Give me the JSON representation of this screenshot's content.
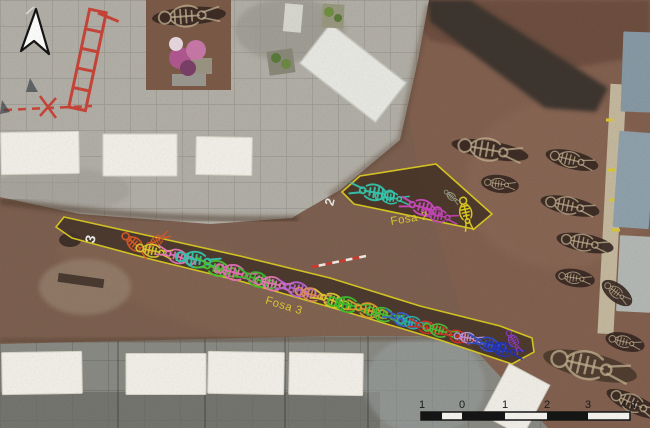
{
  "figure": {
    "description": "Aerial orthophoto of archaeological excavation with two mass graves and individual burials",
    "icons": {
      "north_arrow": "north-arrow-icon",
      "ranging_rod": "ranging-rod",
      "scale_bar": "scale-bar"
    },
    "labels": {
      "fosa2": {
        "name": "Fosa 2",
        "number": "2",
        "label_color": "#dcc832",
        "number_color": "#ececе8"
      },
      "fosa3": {
        "name": "Fosa 3",
        "number": "3",
        "label_color": "#dcc832",
        "number_color": "#ececе8"
      }
    },
    "outline_color": "#d6c623"
  },
  "scalebar": {
    "unit": "m",
    "tick_labels": [
      "1",
      "0",
      "1",
      "2",
      "3",
      "4 m"
    ],
    "ticks": [
      {
        "label": "1",
        "x": 422
      },
      {
        "label": "0",
        "x": 462
      },
      {
        "label": "1",
        "x": 505
      },
      {
        "label": "2",
        "x": 547
      },
      {
        "label": "3",
        "x": 588
      },
      {
        "label": "4 m",
        "x": 630
      }
    ],
    "segments": [
      {
        "x": 421,
        "w": 21,
        "fill": "#151515"
      },
      {
        "x": 442,
        "w": 20,
        "fill": "#f6f4ee"
      },
      {
        "x": 462,
        "w": 43,
        "fill": "#151515"
      },
      {
        "x": 505,
        "w": 42,
        "fill": "#f6f4ee"
      },
      {
        "x": 547,
        "w": 41,
        "fill": "#151515"
      },
      {
        "x": 588,
        "w": 42,
        "fill": "#f6f4ee"
      }
    ],
    "bar": {
      "y": 412,
      "h": 8
    }
  },
  "skeletons": {
    "fosa2": [
      {
        "x": 372,
        "y": 192,
        "a": 190,
        "sc": 1.05,
        "c": "#35c7ae"
      },
      {
        "x": 392,
        "y": 198,
        "a": 8,
        "sc": 0.8,
        "c": "#35c7ae"
      },
      {
        "x": 421,
        "y": 207,
        "a": 195,
        "sc": 1.0,
        "c": "#cc4ac0"
      },
      {
        "x": 440,
        "y": 216,
        "a": 12,
        "sc": 0.85,
        "c": "#c043b6"
      },
      {
        "x": 466,
        "y": 214,
        "a": 78,
        "sc": 0.8,
        "c": "#e0d020"
      },
      {
        "x": 452,
        "y": 197,
        "a": 40,
        "sc": 0.45,
        "c": "#9aa08a"
      }
    ],
    "fosa3": [
      {
        "x": 158,
        "y": 240,
        "a": -30,
        "sc": 0.6,
        "c": "#e05826"
      },
      {
        "x": 136,
        "y": 245,
        "a": 40,
        "sc": 0.8,
        "c": "#e05826"
      },
      {
        "x": 154,
        "y": 251,
        "a": 12,
        "sc": 0.85,
        "c": "#d9cb2e"
      },
      {
        "x": 176,
        "y": 256,
        "a": 198,
        "sc": 0.9,
        "c": "#e878bc"
      },
      {
        "x": 198,
        "y": 260,
        "a": 10,
        "sc": 1.05,
        "c": "#35c7ae"
      },
      {
        "x": 216,
        "y": 268,
        "a": 195,
        "sc": 1.0,
        "c": "#4cc232"
      },
      {
        "x": 236,
        "y": 273,
        "a": 15,
        "sc": 1.0,
        "c": "#e470b4"
      },
      {
        "x": 256,
        "y": 279,
        "a": 200,
        "sc": 0.95,
        "c": "#3fbe2c"
      },
      {
        "x": 274,
        "y": 284,
        "a": 12,
        "sc": 0.9,
        "c": "#e87ab8"
      },
      {
        "x": 296,
        "y": 289,
        "a": 195,
        "sc": 0.95,
        "c": "#bd66d6"
      },
      {
        "x": 313,
        "y": 295,
        "a": 15,
        "sc": 0.85,
        "c": "#e09060"
      },
      {
        "x": 331,
        "y": 300,
        "a": 200,
        "sc": 0.9,
        "c": "#ddcf28"
      },
      {
        "x": 349,
        "y": 305,
        "a": 12,
        "sc": 1.0,
        "c": "#3cc02e"
      },
      {
        "x": 367,
        "y": 310,
        "a": 195,
        "sc": 0.95,
        "c": "#e0a02c"
      },
      {
        "x": 385,
        "y": 315,
        "a": 15,
        "sc": 0.9,
        "c": "#45c335"
      },
      {
        "x": 401,
        "y": 319,
        "a": 200,
        "sc": 0.85,
        "c": "#3b62d8"
      },
      {
        "x": 414,
        "y": 323,
        "a": 12,
        "sc": 0.8,
        "c": "#2db4a4"
      },
      {
        "x": 425,
        "y": 327,
        "a": 195,
        "sc": 0.8,
        "c": "#d62e24"
      },
      {
        "x": 441,
        "y": 331,
        "a": 15,
        "sc": 0.85,
        "c": "#4cc23a"
      },
      {
        "x": 456,
        "y": 336,
        "a": 200,
        "sc": 0.8,
        "c": "#d62e24"
      },
      {
        "x": 469,
        "y": 338,
        "a": 10,
        "sc": 0.7,
        "c": "#b69ae0"
      },
      {
        "x": 487,
        "y": 344,
        "a": 195,
        "sc": 0.9,
        "c": "#2f4ecc"
      },
      {
        "x": 505,
        "y": 350,
        "a": 15,
        "sc": 0.9,
        "c": "#2433b0"
      },
      {
        "x": 514,
        "y": 342,
        "a": 60,
        "sc": 0.6,
        "c": "#8e3cc4"
      }
    ]
  },
  "graves": [
    {
      "x": 490,
      "y": 150,
      "len": 78,
      "rot": 10
    },
    {
      "x": 572,
      "y": 160,
      "len": 54,
      "rot": 14
    },
    {
      "x": 500,
      "y": 184,
      "len": 38,
      "rot": 8
    },
    {
      "x": 570,
      "y": 206,
      "len": 60,
      "rot": 12
    },
    {
      "x": 585,
      "y": 243,
      "len": 58,
      "rot": 11
    },
    {
      "x": 575,
      "y": 278,
      "len": 40,
      "rot": 9
    },
    {
      "x": 617,
      "y": 293,
      "len": 36,
      "rot": 38
    },
    {
      "x": 189,
      "y": 16,
      "len": 74,
      "rot": -4
    },
    {
      "x": 625,
      "y": 342,
      "len": 40,
      "rot": 14
    },
    {
      "x": 634,
      "y": 404,
      "len": 60,
      "rot": 25
    },
    {
      "x": 590,
      "y": 366,
      "len": 96,
      "rot": 13,
      "ry": 13,
      "pale": true
    }
  ],
  "slabs": {
    "bottom": [
      {
        "x": 42,
        "y": 373,
        "w": 80,
        "h": 42,
        "rot": -1
      },
      {
        "x": 166,
        "y": 374,
        "w": 80,
        "h": 41,
        "rot": 0
      },
      {
        "x": 246,
        "y": 373,
        "w": 76,
        "h": 42,
        "rot": 1
      },
      {
        "x": 326,
        "y": 374,
        "w": 74,
        "h": 42,
        "rot": 1
      }
    ],
    "left": [
      {
        "x": 40,
        "y": 153,
        "w": 78,
        "h": 42,
        "rot": -1
      },
      {
        "x": 140,
        "y": 155,
        "w": 74,
        "h": 42,
        "rot": 0
      },
      {
        "x": 224,
        "y": 156,
        "w": 56,
        "h": 38,
        "rot": 1
      }
    ],
    "right": [
      {
        "x": 637,
        "y": 72,
        "w": 30,
        "h": 80,
        "rot": 2,
        "fill": "#8799a4"
      },
      {
        "x": 634,
        "y": 180,
        "w": 36,
        "h": 96,
        "rot": 4,
        "fill": "#8fa1ac"
      },
      {
        "x": 635,
        "y": 274,
        "w": 34,
        "h": 76,
        "rot": 3,
        "fill": "#b4b8b4"
      }
    ]
  },
  "ranging_rod": {
    "x1": 312,
    "y1": 267,
    "x2": 366,
    "y2": 256,
    "segments": 8,
    "red": "#d23a2e",
    "white": "#f0ece4"
  },
  "palette": {
    "soil": "#7c5f4f",
    "soil_dark": "#6a4c3e",
    "pit": "#352720",
    "pavement": "#b2afa7",
    "pavement_bottom": "#8a8a84",
    "white_slab": "#f2f0e8",
    "red_paint": "#cc3326",
    "bone": "#c3b292"
  }
}
